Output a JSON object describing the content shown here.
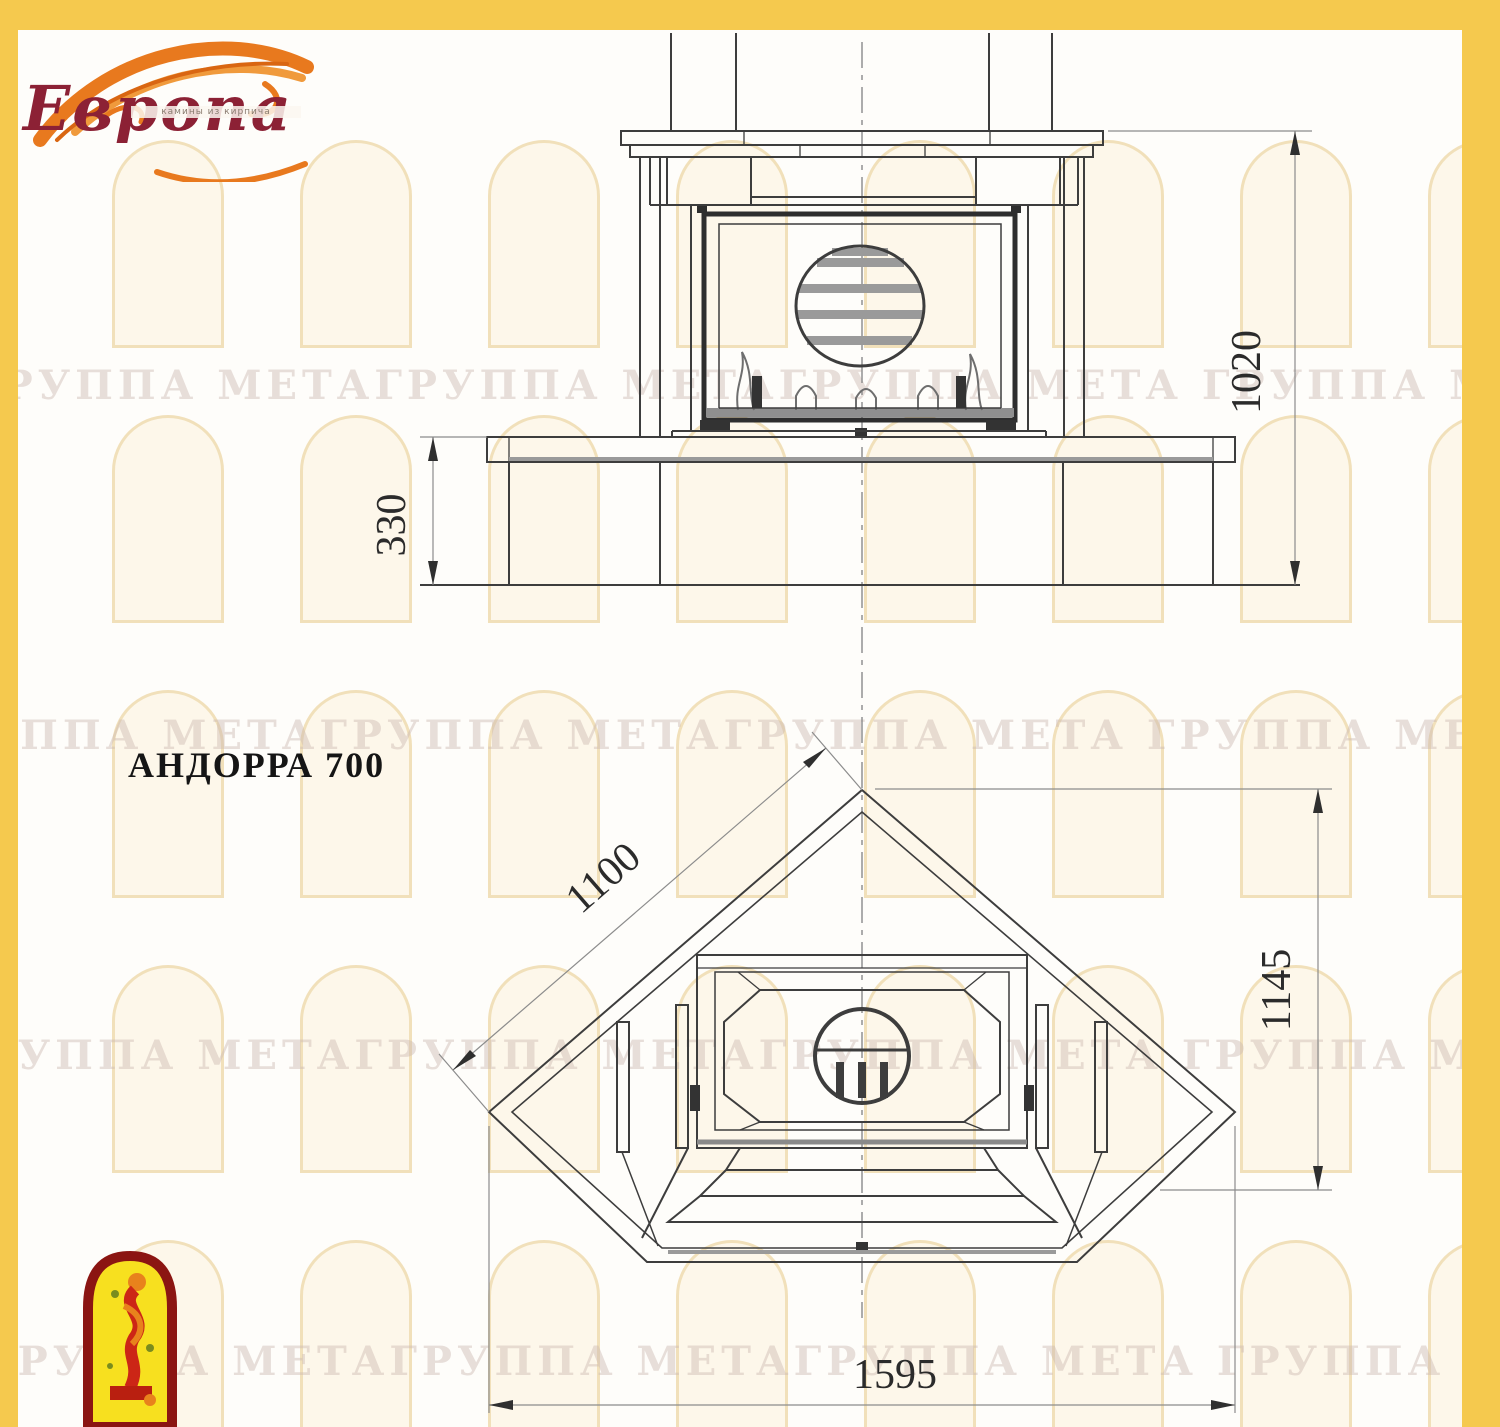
{
  "page": {
    "frame_color": "#F5C94E",
    "background": "#FEFDFA"
  },
  "logo": {
    "brand": "Европа",
    "tagline": "камины из кирпича",
    "brand_color": "#8C2135",
    "flame_color": "#E8791E"
  },
  "title": {
    "model": "АНДОРРА 700"
  },
  "watermark": {
    "text": "ГРУППА МЕТАГРУППА МЕТАГРУППА МЕТА"
  },
  "drawing": {
    "line_color": "#3d3d3d",
    "front_view": {
      "dim_total_height": "1020",
      "dim_bench_height": "330"
    },
    "plan_view": {
      "dim_side": "1100",
      "dim_depth": "1145",
      "dim_width": "1595"
    }
  }
}
